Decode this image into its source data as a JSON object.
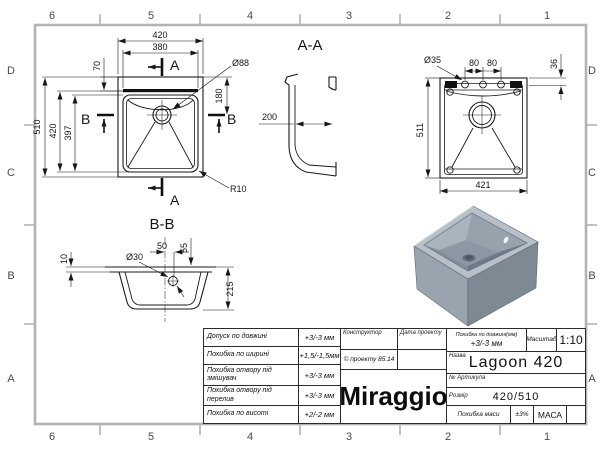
{
  "sheet": {
    "zones": {
      "top": [
        "6",
        "5",
        "4",
        "3",
        "2",
        "1"
      ],
      "bottom": [
        "6",
        "5",
        "4",
        "3",
        "2",
        "1"
      ],
      "left": [
        "D",
        "C",
        "B",
        "A"
      ],
      "right": [
        "D",
        "C",
        "B",
        "A"
      ]
    }
  },
  "plan_view": {
    "dim_width": "420",
    "dim_bowl_width": "380",
    "dim_deck": "70",
    "dim_drain": "Ø88",
    "dim_drain_offset": "180",
    "dim_length": "510",
    "dim_cut_length": "420",
    "dim_bowl_length": "397",
    "dim_radius": "R10",
    "marker_a": "A",
    "marker_b": "B"
  },
  "section_aa": {
    "label": "A-A",
    "dim_depth": "200"
  },
  "bottom_view": {
    "dim_hole": "Ø35",
    "dim_pitch_left": "80",
    "dim_pitch_right": "80",
    "dim_edge": "36",
    "dim_length": "511",
    "dim_width": "421"
  },
  "section_bb": {
    "label": "B-B",
    "dim_flange": "10",
    "dim_hole": "Ø30",
    "dim_offset": "50",
    "dim_hole_depth": "55",
    "dim_height": "215"
  },
  "title_block": {
    "tolerances": [
      {
        "label": "Допуск по довжині",
        "value": "+3/-3 мм"
      },
      {
        "label": "Похибка по ширині",
        "value": "+1,5/-1,5мм"
      },
      {
        "label": "Похибка отвору під змішувач",
        "value": "+3/-3 мм"
      },
      {
        "label": "Похибка отвору під перелив",
        "value": "+3/-3 мм"
      },
      {
        "label": "Похибка по висоті",
        "value": "+2/-2 мм"
      }
    ],
    "constructor_label": "Конструктор",
    "date_label": "Дата проекту",
    "project_note": "© проекту 85.14",
    "logo": "Miraggio",
    "length_tol_label": "Похибка по довжині(мм)",
    "length_tol_value": "+3/-3 мм",
    "scale_label": "Масштаб",
    "scale_value": "1:10",
    "name_label": "Назва",
    "name_value": "Lagoon 420",
    "article_label": "№ Артикула",
    "size_label": "Розмір",
    "size_value": "420/510",
    "mass_tol_label": "Похибка маси",
    "mass_tol_value": "±3%",
    "mass_label": "МАСА"
  }
}
